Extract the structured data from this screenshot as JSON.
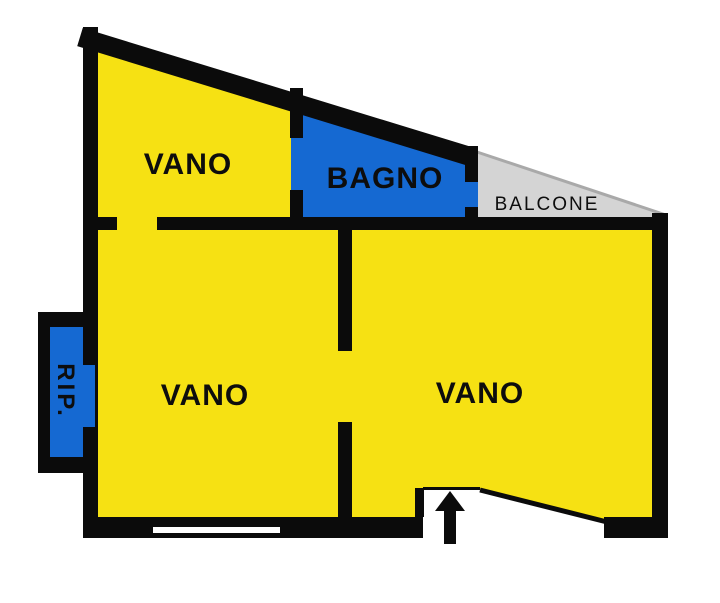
{
  "plan": {
    "type": "apartment-floorplan",
    "rooms": {
      "vano_top": "VANO",
      "bagno": "BAGNO",
      "balcone": "BALCONE",
      "rip": "RIP.",
      "vano_left": "VANO",
      "vano_right": "VANO"
    },
    "colors": {
      "room": "#F6E113",
      "wet": "#1569D2",
      "balcony": "#D4D4D4",
      "balcony_edge": "#A9A9A9",
      "wall": "#0B0B0B",
      "window": "#FFFFFF"
    }
  }
}
